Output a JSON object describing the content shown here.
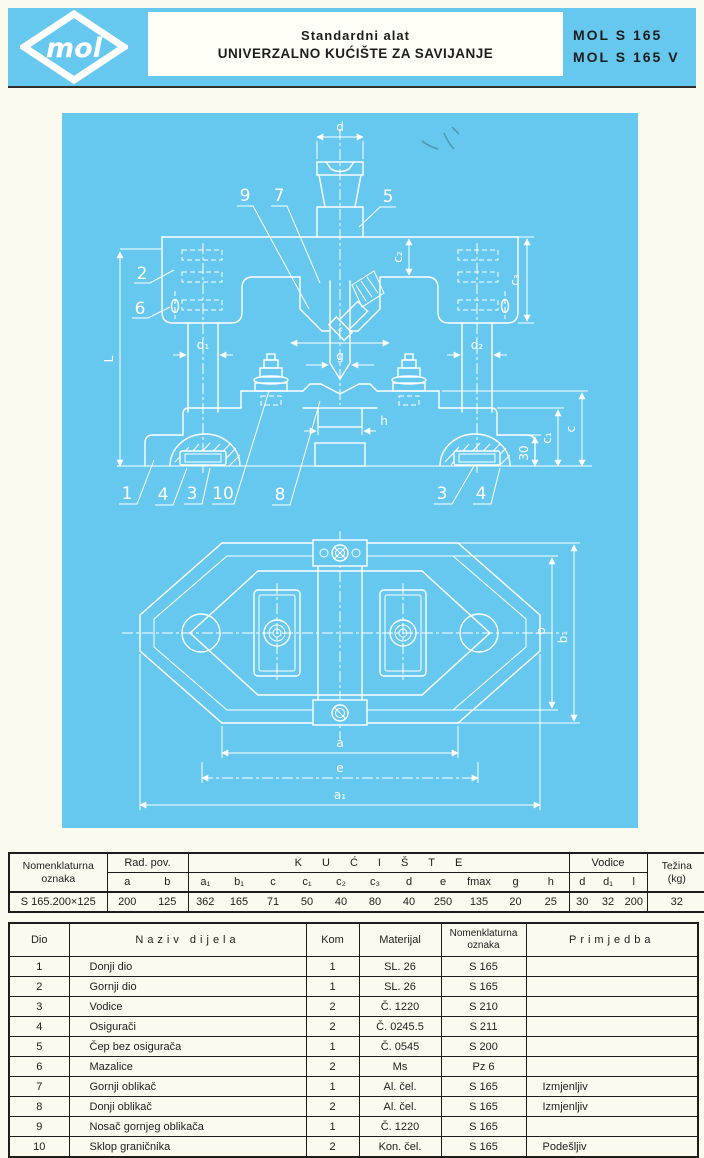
{
  "header": {
    "logo_text": "mol",
    "title_line1": "Standardni alat",
    "title_line2": "UNIVERZALNO KUĆIŠTE ZA SAVIJANJE",
    "model_line1": "MOL S 165",
    "model_line2": "MOL S 165 V"
  },
  "colors": {
    "accent_cyan": "#66C7EF",
    "page_background": "#FBFAEF",
    "drawing_lines": "#FFFFFF",
    "ink": "#1D1D1B"
  },
  "drawing": {
    "labels": {
      "d": "d",
      "c2": "c₂",
      "c3": "c₃",
      "d1": "d₁",
      "d2": "d₂",
      "f": "f",
      "g": "g",
      "h": "h",
      "L": "L",
      "c1": "c₁",
      "c": "c",
      "n30": "30",
      "a": "a",
      "e": "e",
      "a1": "a₁",
      "b": "b",
      "b1": "b₁"
    },
    "part_numbers": {
      "p1": "1",
      "p2": "2",
      "p3": "3",
      "p4": "4",
      "p5": "5",
      "p6": "6",
      "p7": "7",
      "p8": "8",
      "p9": "9",
      "p10": "10"
    }
  },
  "spec_table": {
    "nomenklaturna": "Nomenklaturna\noznaka",
    "rad_pov": "Rad. pov.",
    "kuciste": "KUĆIŠTE",
    "vodice": "Vodice",
    "tezina": "Težina\n(kg)",
    "sub_rad": [
      "a",
      "b"
    ],
    "sub_kuciste": [
      "a₁",
      "b₁",
      "c",
      "c₁",
      "c₂",
      "c₃",
      "d",
      "e",
      "fmax",
      "g",
      "h"
    ],
    "sub_vodice": [
      "d",
      "d₁",
      "l"
    ],
    "row": {
      "oznaka": "S 165.200×125",
      "values": [
        "200",
        "125",
        "362",
        "165",
        "71",
        "50",
        "40",
        "80",
        "40",
        "250",
        "135",
        "20",
        "25",
        "30",
        "32",
        "200",
        "32"
      ]
    }
  },
  "parts_table": {
    "headers": {
      "dio": "Dio",
      "naziv": "Naziv dijela",
      "kom": "Kom",
      "materijal": "Materijal",
      "oznaka": "Nomenklaturna\noznaka",
      "primjedba": "Primjedba"
    },
    "rows": [
      {
        "dio": "1",
        "naziv": "Donji dio",
        "kom": "1",
        "materijal": "SL. 26",
        "oznaka": "S 165",
        "primjedba": ""
      },
      {
        "dio": "2",
        "naziv": "Gornji dio",
        "kom": "1",
        "materijal": "SL. 26",
        "oznaka": "S 165",
        "primjedba": ""
      },
      {
        "dio": "3",
        "naziv": "Vodice",
        "kom": "2",
        "materijal": "Č. 1220",
        "oznaka": "S 210",
        "primjedba": ""
      },
      {
        "dio": "4",
        "naziv": "Osigurači",
        "kom": "2",
        "materijal": "Č. 0245.5",
        "oznaka": "S 211",
        "primjedba": ""
      },
      {
        "dio": "5",
        "naziv": "Čep bez osigurača",
        "kom": "1",
        "materijal": "Č. 0545",
        "oznaka": "S 200",
        "primjedba": ""
      },
      {
        "dio": "6",
        "naziv": "Mazalice",
        "kom": "2",
        "materijal": "Ms",
        "oznaka": "Pz 6",
        "primjedba": ""
      },
      {
        "dio": "7",
        "naziv": "Gornji oblikač",
        "kom": "1",
        "materijal": "Al. čel.",
        "oznaka": "S 165",
        "primjedba": "Izmjenljiv"
      },
      {
        "dio": "8",
        "naziv": "Donji oblikač",
        "kom": "2",
        "materijal": "Al. čel.",
        "oznaka": "S 165",
        "primjedba": "Izmjenljiv"
      },
      {
        "dio": "9",
        "naziv": "Nosač gornjeg oblikača",
        "kom": "1",
        "materijal": "Č. 1220",
        "oznaka": "S 165",
        "primjedba": ""
      },
      {
        "dio": "10",
        "naziv": "Sklop graničnika",
        "kom": "2",
        "materijal": "Kon. čel.",
        "oznaka": "S 165",
        "primjedba": "Podešljiv"
      }
    ]
  }
}
